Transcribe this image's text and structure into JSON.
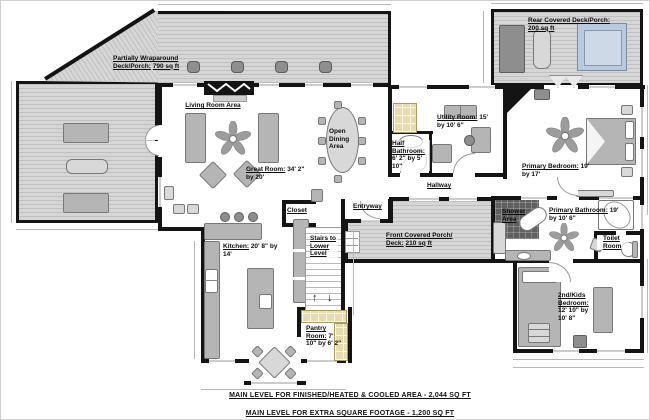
{
  "colors": {
    "wall": "#141414",
    "deck_fill": "#d6d6d6",
    "deck_stripe": "#c0c0c0",
    "furniture": "#b5b5b5",
    "shelf_tan": "#e8dcae",
    "shower_tile": "#606060",
    "hot_tub": "#b9c9de",
    "dim_line": "#b8b8b8"
  },
  "icons": {
    "stairs_up": "↑",
    "stairs_down": "↓"
  },
  "rooms": {
    "wrap_deck": {
      "name": "Partially Wraparound Deck/Porch:",
      "dims": "790 sq ft"
    },
    "rear_deck": {
      "name": "Rear Covered Deck/Porch:",
      "dims": "200 sq ft"
    },
    "front_porch": {
      "name": "Front Covered Porch/ Deck:",
      "dims": "210 sq ft"
    },
    "living_room": {
      "name": "Living Room Area",
      "dims": ""
    },
    "great_room": {
      "name": "Great Room:",
      "dims": "34' 2\" by 20'"
    },
    "open_dining": {
      "name": "Open Dining Area",
      "dims": ""
    },
    "kitchen": {
      "name": "Kitchen:",
      "dims": "20' 8\" by 14'"
    },
    "pantry": {
      "name": "Pantry Room:",
      "dims": "7' 10\" by 6' 2\""
    },
    "stairs": {
      "name": "Stairs to Lower Level",
      "dims": ""
    },
    "closet": {
      "name": "Closet",
      "dims": ""
    },
    "entryway": {
      "name": "Entryway",
      "dims": ""
    },
    "hallway": {
      "name": "Hallway",
      "dims": ""
    },
    "utility": {
      "name": "Utility Room:",
      "dims": "15' by 10' 6\""
    },
    "half_bath": {
      "name": "Half Bathroom:",
      "dims": "6' 2\" by 5' 10\""
    },
    "primary_bedroom": {
      "name": "Primary Bedroom:",
      "dims": "19' by 17'"
    },
    "primary_bathroom": {
      "name": "Primary Bathroom:",
      "dims": "19' by 10' 6\""
    },
    "shower": {
      "name": "Shower Area",
      "dims": ""
    },
    "toilet_room": {
      "name": "Toilet Room",
      "dims": ""
    },
    "kids_bedroom": {
      "name": "2nd/Kids Bedroom:",
      "dims": "12' 10\" by 10' 8\""
    }
  },
  "footer": {
    "line1": "MAIN LEVEL FOR FINISHED/HEATED & COOLED AREA - 2,044 SQ FT",
    "line2": "MAIN LEVEL FOR EXTRA SQUARE FOOTAGE - 1,200 SQ FT"
  }
}
